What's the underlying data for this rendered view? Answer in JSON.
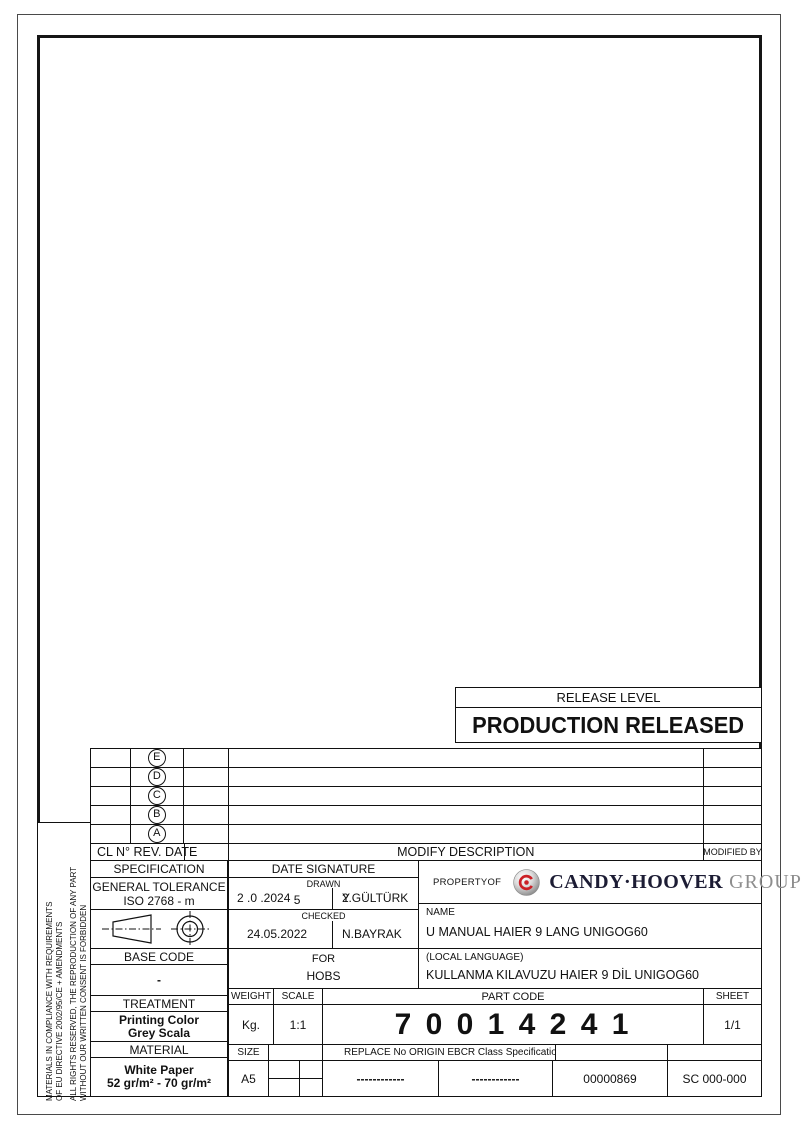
{
  "sheet": {
    "release": {
      "label": "RELEASE LEVEL",
      "value": "PRODUCTION RELEASED"
    },
    "side_note": {
      "line1": "MATERIALS IN COMPLIANCE WITH REQUIREMENTS",
      "line2": "OF EU DIRECTIVE 2002/95/CE + AMENDMENTS",
      "line3": "ALL RIGHTS RESERVED, THE REPRODUCTION OF ANY PART",
      "line4": "WITHOUT OUR WRITTEN CONSENT IS FORBIDDEN"
    },
    "revisions": {
      "letters": [
        "E",
        "D",
        "C",
        "B",
        "A"
      ],
      "header_left": "CL N° REV. DATE",
      "header_center": "MODIFY DESCRIPTION",
      "header_right": "MODIFIED BY"
    },
    "specification": {
      "header": "SPECIFICATION",
      "tolerance_line1": "GENERAL TOLERANCE",
      "tolerance_line2": "ISO 2768 - m"
    },
    "date_signature": {
      "header": "DATE SIGNATURE",
      "drawn_label": "DRAWN",
      "drawn_date": "2 .0 .2024",
      "drawn_date_extra": "5",
      "drawn_name": "Y.GÜLTÜRK",
      "drawn_name_overlay": "2",
      "checked_label": "CHECKED",
      "checked_date": "24.05.2022",
      "checked_name": "N.BAYRAK"
    },
    "property": {
      "label": "PROPERTYOF",
      "brand": "CANDY·HOOVER",
      "brand_suffix": "GROUP",
      "logo_red": "#cb2026",
      "brand_dark": "#1c1c34",
      "brand_grey": "#8e8e8e"
    },
    "name_block": {
      "label": "NAME",
      "value": "U MANUAL HAIER 9 LANG UNIGOG60"
    },
    "local_block": {
      "label": "(LOCAL LANGUAGE)",
      "value": "KULLANMA KILAVUZU HAIER 9 DİL UNIGOG60"
    },
    "for_block": {
      "label": "FOR",
      "value": "HOBS"
    },
    "base_code": {
      "header": "BASE CODE",
      "value": "-"
    },
    "treatment": {
      "header": "TREATMENT",
      "line1": "Printing Color",
      "line2": "Grey Scala"
    },
    "material": {
      "header": "MATERIAL",
      "line1": "White Paper",
      "line2": "52 gr/m² - 70 gr/m²"
    },
    "weight": {
      "header": "WEIGHT",
      "value": "Kg."
    },
    "scale": {
      "header": "SCALE",
      "value": "1:1"
    },
    "part_code": {
      "header": "PART CODE",
      "value": "7 0 0 1 4 2 4 1"
    },
    "sheet_no": {
      "header": "SHEET",
      "value": "1/1"
    },
    "size": {
      "header": "SIZE",
      "value": "A5"
    },
    "replace_row": {
      "header": "REPLACE No ORIGIN EBCR Class Specification",
      "dash1": "------------",
      "dash2": "------------",
      "code": "00000869",
      "sc_code": "SC 000-000"
    }
  }
}
